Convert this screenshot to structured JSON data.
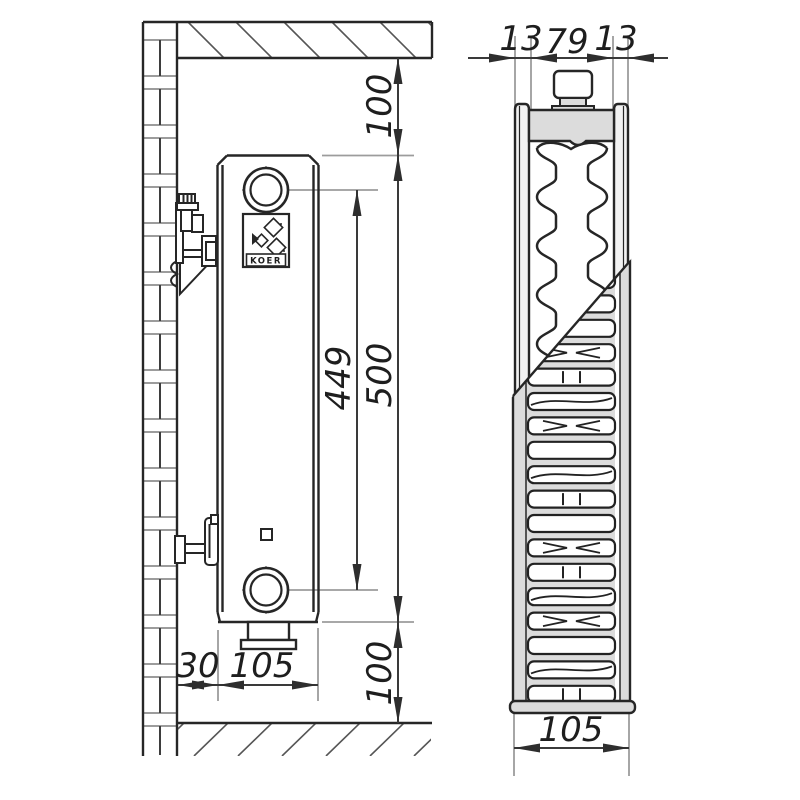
{
  "side_view": {
    "dims": {
      "top_clearance": "100",
      "height": "500",
      "connection_spacing": "449",
      "wall_gap": "30",
      "depth": "105",
      "bottom_clearance": "100"
    },
    "logo": "KOER"
  },
  "section_view": {
    "dims": {
      "front_panel": "13",
      "core": "79",
      "rear_panel": "13",
      "total_depth": "105"
    }
  },
  "colors": {
    "line": "#262626",
    "dim_line": "#3a3a3a",
    "thin_line": "#9c9c9c",
    "gray_fill": "#dcdcdc",
    "panel_fill": "#f2f2f2",
    "background": "#ffffff"
  }
}
